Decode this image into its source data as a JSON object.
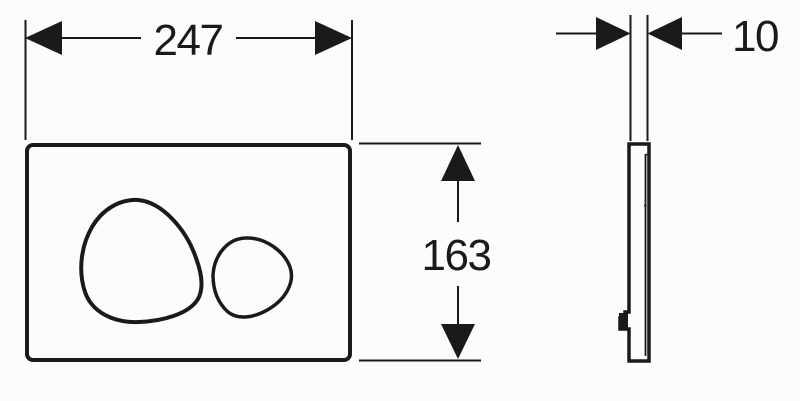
{
  "drawing": {
    "dimensions": {
      "width": {
        "label": "247"
      },
      "height": {
        "label": "163"
      },
      "depth": {
        "label": "10"
      }
    },
    "colors": {
      "line": "#1a1a1a",
      "background": "#fcfcfc"
    }
  }
}
